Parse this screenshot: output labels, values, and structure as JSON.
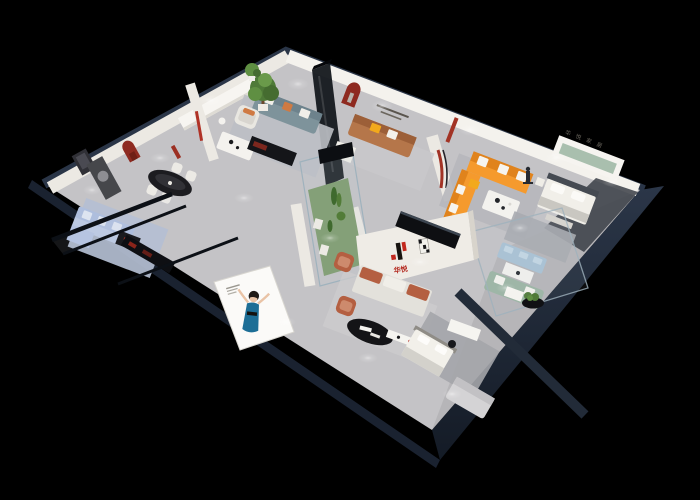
{
  "meta": {
    "description": "3D isometric cutaway render of a furniture brand showroom floor plan on a black background",
    "render_type": "architectural dollhouse view"
  },
  "branding": {
    "logo_mark": "H",
    "logo_cn": "华悦",
    "right_wall_text": "华 悦 家 居",
    "billboard_figure": "hostess in blue dress"
  },
  "palette": {
    "background": "#000000",
    "shell_navy": "#26303f",
    "shell_navy_dark": "#151c28",
    "wall_white": "#ece9e3",
    "wall_bright": "#f4f2ed",
    "floor_grey": "#c4c3c6",
    "floor_dark": "#3a3e45",
    "brand_red": "#c2281e",
    "arch_red": "#8e2a20",
    "sofa_orange": "#f59a2d",
    "sofa_orange_dark": "#e0831c",
    "pillow_yellow": "#f2a91c",
    "sofa_caramel": "#b5764a",
    "sofa_blue": "#aebedd",
    "sofa_teal": "#7e939b",
    "sofa_sage": "#9cb5a4",
    "sofa_tufted_blue": "#a9c2d4",
    "sofa_rust": "#b45f41",
    "plant_green": "#4f7a38",
    "glass_line": "#9fb2bd",
    "dark_furniture": "#141519",
    "rug_blue": "#b4bfd2",
    "rug_grey": "#a9abb0",
    "woman_dress": "#1d6e96",
    "niche_sage": "#a9bfae"
  },
  "objects": [
    "orange L-shaped sectional sofa",
    "caramel leather sofa with yellow pillows",
    "light blue sectional sofa with media console",
    "teal fabric sofa and white armchair",
    "sage green sofa and blue tufted sofa in glass box",
    "rust lounge chairs and sofa at brand wall",
    "double bed display",
    "single bed display",
    "black oval dining table with four white chairs",
    "glass plant showcase",
    "brand logo partition wall",
    "promo billboard with hostess",
    "red arched wall niches",
    "decorative statue",
    "potted tree"
  ]
}
